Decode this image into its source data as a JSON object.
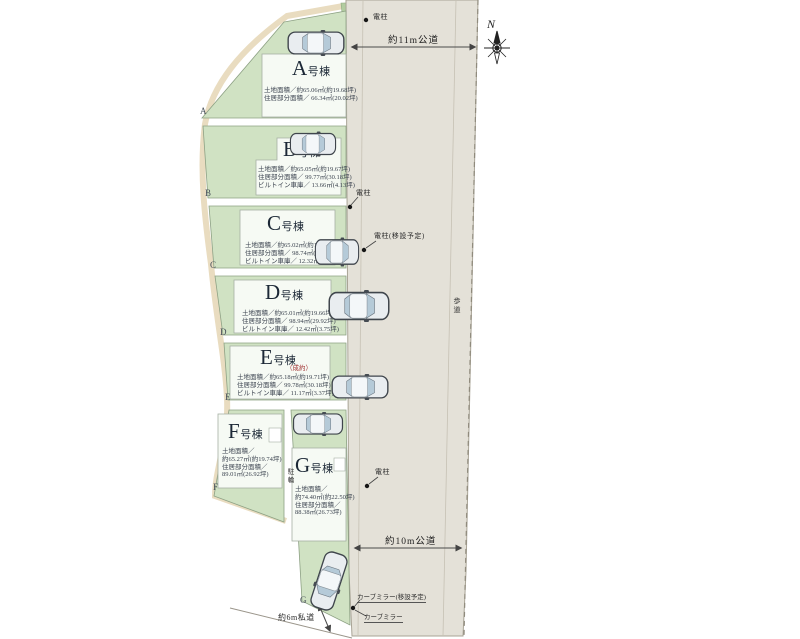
{
  "compass": {
    "north_label": "N"
  },
  "roads": {
    "top_road_label": "約11m公道",
    "bottom_road_label": "約10m公道",
    "private_road_label": "約6m私道",
    "sidewalk_left": "歩道",
    "sidewalk_right": "歩道"
  },
  "markers": {
    "pole_top": "電柱",
    "pole_mid": "電柱",
    "pole_relocate": "電柱(移設予定)",
    "pole_lower": "電柱",
    "curve_mirror_relocate": "カーブミラー(移設予定)",
    "curve_mirror": "カーブミラー",
    "bicycle_area": "駐輪"
  },
  "lots": [
    {
      "corner_label": "A",
      "name_initial": "A",
      "name_suffix": "号棟",
      "area_lines": [
        "土地面積／約65.06㎡(約19.68坪)",
        "住居部分面積／ 66.34㎡(20.02坪)"
      ]
    },
    {
      "corner_label": "B",
      "name_initial": "B",
      "name_suffix": "号棟",
      "area_lines": [
        "土地面積／約65.05㎡(約19.67坪)",
        "住居部分面積／ 99.77㎡(30.18坪)",
        "ビルトイン車庫／ 13.66㎡(4.13坪)"
      ]
    },
    {
      "corner_label": "C",
      "name_initial": "C",
      "name_suffix": "号棟",
      "area_lines": [
        "土地面積／約65.02㎡(約19.66坪)",
        "住居部分面積／ 98.74㎡(29.86坪)",
        "ビルトイン車庫／ 12.32㎡(3.72坪)"
      ]
    },
    {
      "corner_label": "D",
      "name_initial": "D",
      "name_suffix": "号棟",
      "area_lines": [
        "土地面積／約65.01㎡(約19.66坪)",
        "住居部分面積／ 98.94㎡(29.92坪)",
        "ビルトイン車庫／ 12.42㎡(3.75坪)"
      ]
    },
    {
      "corner_label": "E",
      "name_initial": "E",
      "name_suffix": "号棟",
      "note": "（成約）",
      "area_lines": [
        "土地面積／約65.18㎡(約19.71坪)",
        "住居部分面積／ 99.78㎡(30.18坪)",
        "ビルトイン車庫／ 11.17㎡(3.37坪)"
      ]
    },
    {
      "corner_label": "F",
      "name_initial": "F",
      "name_suffix": "号棟",
      "area_lines": [
        "土地面積／",
        "約65.27㎡(約19.74坪)",
        "住居部分面積／",
        "89.01㎡(26.92坪)"
      ]
    },
    {
      "corner_label": "G",
      "name_initial": "G",
      "name_suffix": "号棟",
      "area_lines": [
        "土地面積／",
        "約74.40㎡(約22.50坪)",
        "住居部分面積／",
        "88.38㎡(26.73坪)"
      ]
    }
  ]
}
